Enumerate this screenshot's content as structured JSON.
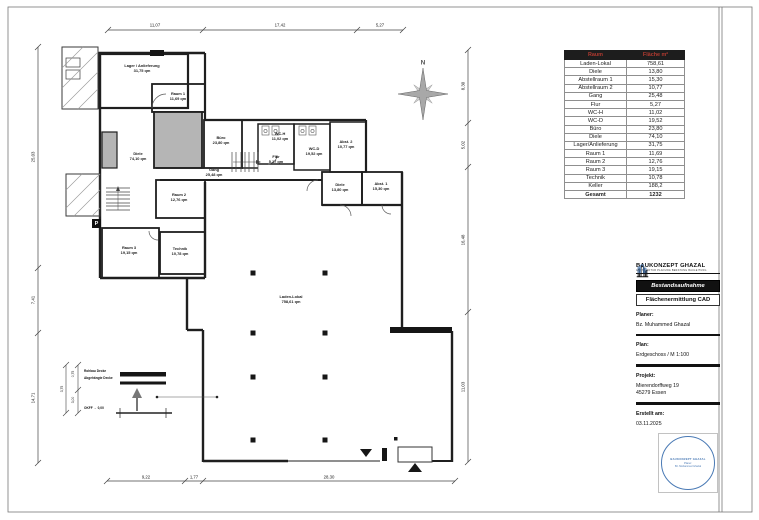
{
  "table": {
    "header_room": "Raum",
    "header_area": "Fläche m²",
    "rows": [
      {
        "name": "Laden-Lokal",
        "value": "758,61"
      },
      {
        "name": "Diele",
        "value": "13,80"
      },
      {
        "name": "Abstellraum 1",
        "value": "15,30"
      },
      {
        "name": "Abstellraum 2",
        "value": "10,77"
      },
      {
        "name": "Gang",
        "value": "25,48"
      },
      {
        "name": "Flur",
        "value": "5,27"
      },
      {
        "name": "WC-H",
        "value": "11,02"
      },
      {
        "name": "WC-D",
        "value": "19,52"
      },
      {
        "name": "Büro",
        "value": "23,80"
      },
      {
        "name": "Diele",
        "value": "74,10"
      },
      {
        "name": "Lager/Anlieferung",
        "value": "31,75"
      },
      {
        "name": "Raum 1",
        "value": "11,69"
      },
      {
        "name": "Raum 2",
        "value": "12,76"
      },
      {
        "name": "Raum 3",
        "value": "19,15"
      },
      {
        "name": "Technik",
        "value": "10,78"
      },
      {
        "name": "Keller",
        "value": "188,2"
      }
    ],
    "total": {
      "name": "Gesamt",
      "value": "1232"
    }
  },
  "title_block": {
    "company": "BAUKONZEPT GHAZAL",
    "tagline": "ARCHITEKTUR PLANUNG BERATUNG BAULEITUNG",
    "doc_type_1": "Bestandsaufnahme",
    "doc_type_2": "Flächenermittlung CAD",
    "planner_label": "Planer:",
    "planner": "Bz. Muhammed Ghazal",
    "plan_label": "Plan:",
    "plan": "Erdgeschoss / M 1:100",
    "project_label": "Projekt:",
    "project_line1": "Mierendorffweg 19",
    "project_line2": "45279 Essen",
    "created_label": "Erstellt am:",
    "created": "03.11.2025",
    "stamp_company": "BAUKONZEPT GHAZAL",
    "stamp_line1": "Planer:",
    "stamp_line2": "Bz. Muhammed Ghazal"
  },
  "plan": {
    "north_label": "N",
    "parking_label": "P",
    "rooms": [
      {
        "name": "Lager / Anlieferung",
        "area": "31,75 qm"
      },
      {
        "name": "Raum 1",
        "area": "11,69 qm"
      },
      {
        "name": "Diele",
        "area": "74,10 qm"
      },
      {
        "name": "Büro",
        "area": "23,80 qm"
      },
      {
        "name": "Gang",
        "area": "25,48 qm"
      },
      {
        "name": "WC-H",
        "area": "11,02 qm"
      },
      {
        "name": "WC-D",
        "area": "19,52 qm"
      },
      {
        "name": "Abst. 2",
        "area": "10,77 qm"
      },
      {
        "name": "Flur",
        "area": "5,27 qm"
      },
      {
        "name": "Diele",
        "area": "13,80 qm"
      },
      {
        "name": "Abst. 1",
        "area": "15,30 qm"
      },
      {
        "name": "Raum 2",
        "area": "12,76 qm"
      },
      {
        "name": "Raum 3",
        "area": "19,15 qm"
      },
      {
        "name": "Technik",
        "area": "10,78 qm"
      },
      {
        "name": "Laden-Lokal",
        "area": "758,61 qm"
      }
    ],
    "dims": {
      "top": [
        "11,07",
        "17,42",
        "5,27"
      ],
      "bottom": [
        "9,22",
        "1,77",
        "28,30"
      ],
      "left": [
        "25,03",
        "7,41",
        "14,71"
      ],
      "right": [
        "8,30",
        "5,02",
        "16,48",
        "11,03"
      ]
    },
    "detail": {
      "label1": "Rohbau Decke",
      "label2": "Abgehängte Decke",
      "note": "OKFF → 0,00",
      "dims": [
        "3,75",
        "0,75",
        "3,00"
      ]
    }
  }
}
